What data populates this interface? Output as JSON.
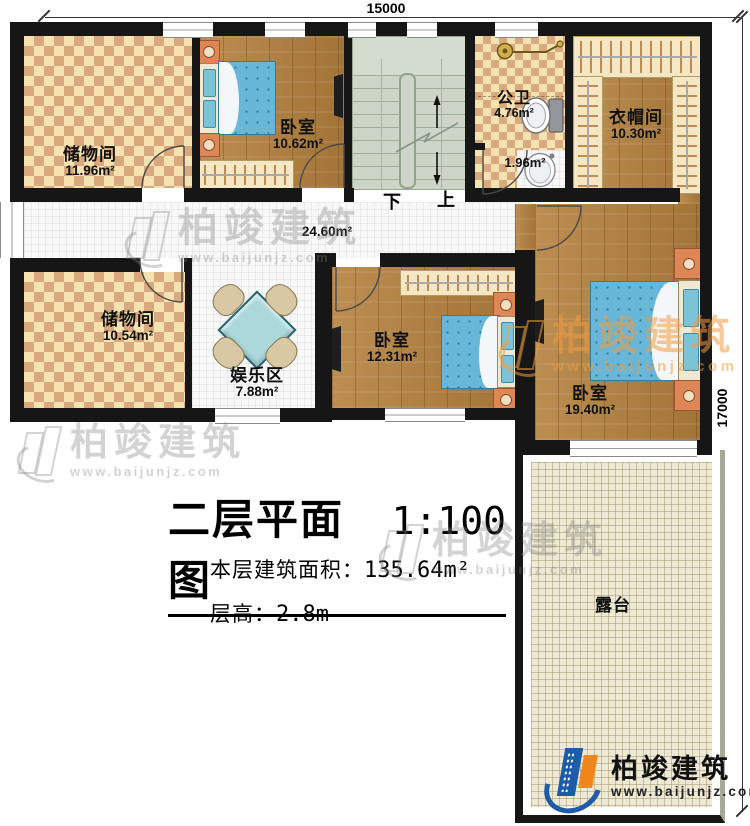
{
  "dimensions": {
    "width": "15000",
    "height": "17000"
  },
  "title": {
    "name": "二层平面图",
    "scale": "1:100",
    "area_label": "本层建筑面积：",
    "area_value": "135.64m²",
    "floor_height_label": "层高：",
    "floor_height_value": "2.8m"
  },
  "stairs": {
    "down": "下",
    "up": "上"
  },
  "rooms": [
    {
      "name": "储物间",
      "area": "11.96m²"
    },
    {
      "name": "卧室",
      "area": "10.62m²"
    },
    {
      "name": "公卫",
      "area": "4.76m²"
    },
    {
      "name": "",
      "area": "1.96m²"
    },
    {
      "name": "衣帽间",
      "area": "10.30m²"
    },
    {
      "name": "",
      "area": "24.60m²"
    },
    {
      "name": "储物间",
      "area": "10.54m²"
    },
    {
      "name": "娱乐区",
      "area": "7.88m²"
    },
    {
      "name": "卧室",
      "area": "12.31m²"
    },
    {
      "name": "卧室",
      "area": "19.40m²"
    },
    {
      "name": "露台",
      "area": ""
    }
  ],
  "brand": {
    "name": "柏竣建筑",
    "website": "www.baijunjz.com"
  },
  "colors": {
    "wall": "#161616",
    "wood_floor": "#b5813e",
    "checker_light": "#f6e2b0",
    "checker_dark": "#d8a97c",
    "bed_blue": "#68b6d8",
    "stairs_green": "#ccd5c7",
    "terrace_beige": "#eee9d4",
    "logo_blue": "#1d5ca8",
    "logo_orange": "#f08519"
  }
}
